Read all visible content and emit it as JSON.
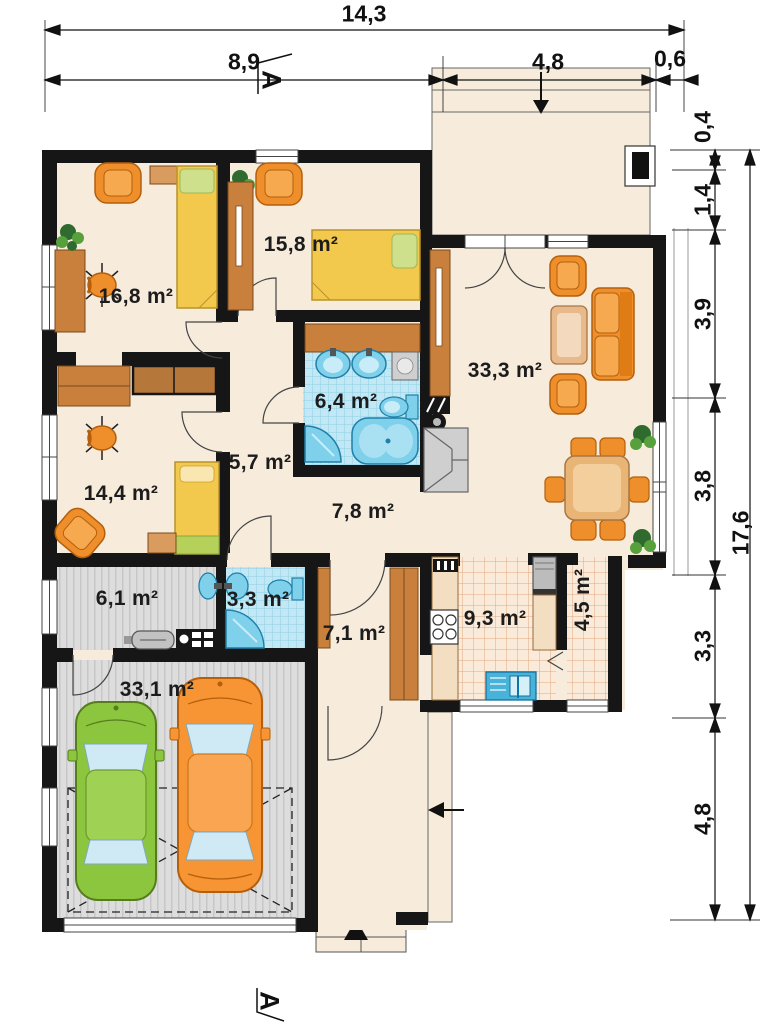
{
  "section_markers": {
    "top": "A",
    "bottom": "A"
  },
  "dimensions": {
    "top": {
      "total": "14,3",
      "segments": [
        "8,9",
        "4,8",
        "0,6"
      ]
    },
    "right": {
      "total": "17,6",
      "segments": [
        "0,4",
        "1,4",
        "3,9",
        "3,8",
        "3,3",
        "4,8"
      ]
    }
  },
  "rooms": [
    {
      "id": "bedroom-1",
      "label": "16,8 m²"
    },
    {
      "id": "bedroom-2",
      "label": "15,8 m²"
    },
    {
      "id": "living-room",
      "label": "33,3 m²"
    },
    {
      "id": "bathroom",
      "label": "6,4 m²"
    },
    {
      "id": "corridor",
      "label": "5,7 m²"
    },
    {
      "id": "bedroom-3",
      "label": "14,4 m²"
    },
    {
      "id": "hall",
      "label": "7,8 m²"
    },
    {
      "id": "utility",
      "label": "6,1 m²"
    },
    {
      "id": "wc",
      "label": "3,3 m²"
    },
    {
      "id": "hallway",
      "label": "7,1 m²"
    },
    {
      "id": "kitchen",
      "label": "9,3 m²"
    },
    {
      "id": "pantry",
      "label": "4,5 m²"
    },
    {
      "id": "garage",
      "label": "33,1 m²"
    }
  ],
  "colors": {
    "wall": "#161616",
    "floor": "#f7ecdc",
    "bath_tile": "#c2e8f5",
    "kitchen_tile": "#f9ead9",
    "garage_floor": "#dddddd",
    "wood": "#c8803c",
    "furniture_orange": "#ef8f2b",
    "bed_yellow": "#f2c84d",
    "fixture_blue": "#7fd0ea",
    "car_green": "#8cc63f",
    "car_orange": "#f79433"
  }
}
